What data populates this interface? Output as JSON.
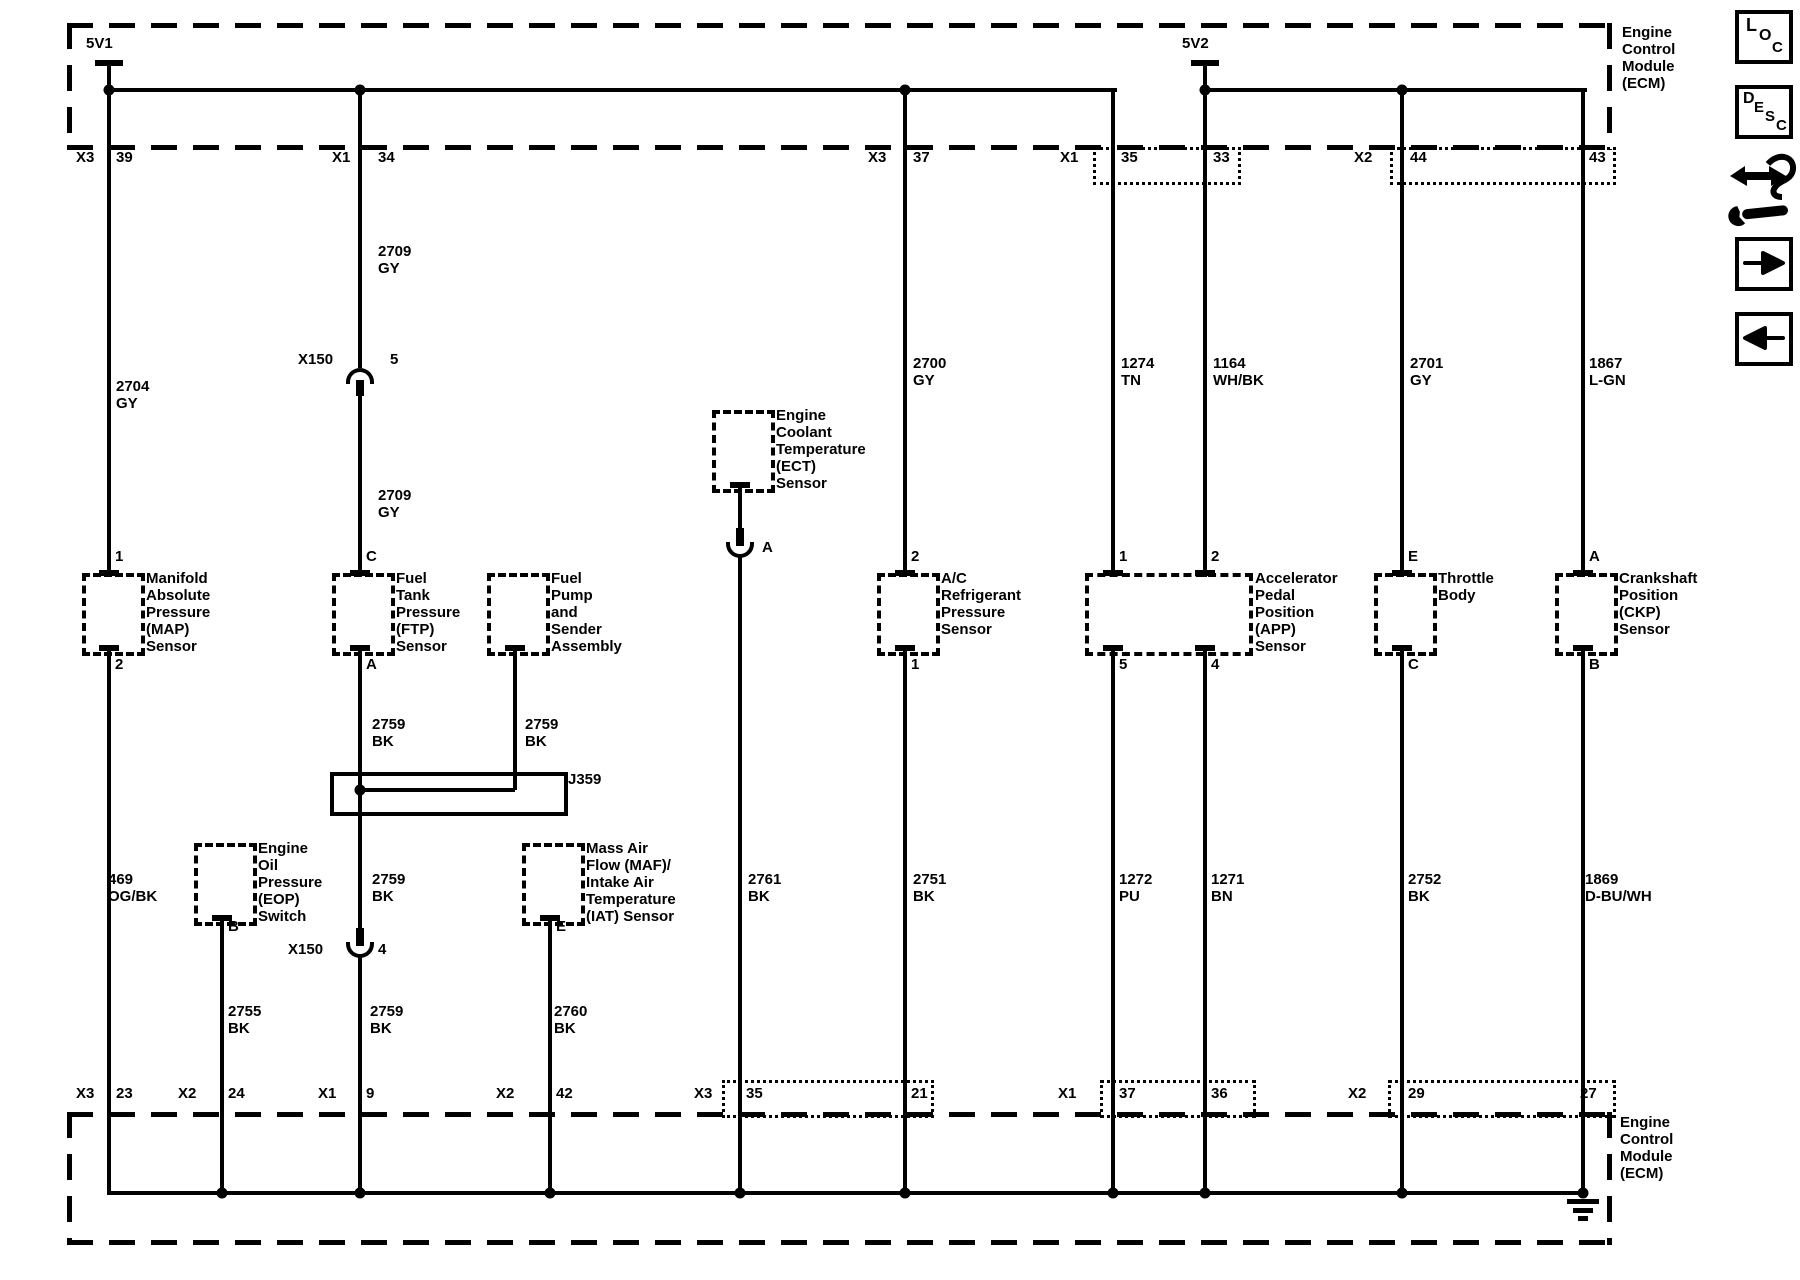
{
  "ecm": {
    "top_label": "Engine\nControl\nModule\n(ECM)",
    "bottom_label": "Engine\nControl\nModule\n(ECM)"
  },
  "power": {
    "v1": "5V1",
    "v2": "5V2"
  },
  "top_pins": {
    "c1_conn": "X3",
    "c1_pin": "39",
    "c3_conn": "X1",
    "c3_pin": "34",
    "c6_conn": "X3",
    "c6_pin": "37",
    "c7a_conn": "X1",
    "c7a_pin": "35",
    "c7b_pin": "33",
    "c8_conn": "X2",
    "c8_pin": "44",
    "c9_pin": "43"
  },
  "bottom_pins": {
    "c1_conn": "X3",
    "c1_pin": "23",
    "c2_conn": "X2",
    "c2_pin": "24",
    "c3_conn": "X1",
    "c3_pin": "9",
    "c4_conn": "X2",
    "c4_pin": "42",
    "c5_conn": "X3",
    "c5_pin": "35",
    "c6_pin": "21",
    "c7a_conn": "X1",
    "c7a_pin": "37",
    "c7b_pin": "36",
    "c8_conn": "X2",
    "c8_pin": "29",
    "c9_pin": "27"
  },
  "wires": {
    "map_supply": "2704\nGY",
    "ftp_supply_upper": "2709\nGY",
    "ftp_supply_lower": "2709\nGY",
    "ac_supply": "2700\nGY",
    "app1_supply": "1274\nTN",
    "app2_supply": "1164\nWH/BK",
    "tb_supply": "2701\nGY",
    "ckp_supply": "1867\nL-GN",
    "ftp_low_upper": "2759\nBK",
    "pump_low": "2759\nBK",
    "ftp_low_mid": "2759\nBK",
    "ftp_low_lower": "2759\nBK",
    "map_low": "469\nOG/BK",
    "eop_low": "2755\nBK",
    "maf_low": "2760\nBK",
    "ect_low": "2761\nBK",
    "ac_low": "2751\nBK",
    "app1_low": "1272\nPU",
    "app2_low": "1271\nBN",
    "tb_low": "2752\nBK",
    "ckp_low": "1869\nD-BU/WH"
  },
  "splice": {
    "label": "J359"
  },
  "inline_connectors": {
    "x150_upper_name": "X150",
    "x150_upper_pin": "5",
    "x150_lower_name": "X150",
    "x150_lower_pin": "4",
    "ect_conn_pin": "A"
  },
  "components": {
    "map": {
      "label": "Manifold\nAbsolute\nPressure\n(MAP)\nSensor",
      "pin_top": "1",
      "pin_bottom": "2"
    },
    "ftp": {
      "label": "Fuel\nTank\nPressure\n(FTP)\nSensor",
      "pin_top": "C",
      "pin_bottom": "A"
    },
    "pump": {
      "label": "Fuel\nPump\nand\nSender\nAssembly"
    },
    "ect": {
      "label": "Engine\nCoolant\nTemperature\n(ECT)\nSensor"
    },
    "ac": {
      "label": "A/C\nRefrigerant\nPressure\nSensor",
      "pin_top": "2",
      "pin_bottom": "1"
    },
    "app": {
      "label": "Accelerator\nPedal\nPosition\n(APP)\nSensor",
      "pin_top_1": "1",
      "pin_top_2": "2",
      "pin_bottom_1": "5",
      "pin_bottom_2": "4"
    },
    "tb": {
      "label": "Throttle\nBody",
      "pin_top": "E",
      "pin_bottom": "C"
    },
    "ckp": {
      "label": "Crankshaft\nPosition\n(CKP)\nSensor",
      "pin_top": "A",
      "pin_bottom": "B"
    },
    "eop": {
      "label": "Engine\nOil\nPressure\n(EOP)\nSwitch",
      "pin_bottom": "B"
    },
    "maf": {
      "label": "Mass Air\nFlow (MAF)/\nIntake Air\nTemperature\n(IAT) Sensor",
      "pin_bottom": "E"
    }
  },
  "toolbar": {
    "loc": [
      "L",
      "O",
      "C"
    ],
    "desc": [
      "D",
      "E",
      "S",
      "C"
    ]
  },
  "colors": {
    "line": "#000000",
    "background": "#ffffff"
  }
}
